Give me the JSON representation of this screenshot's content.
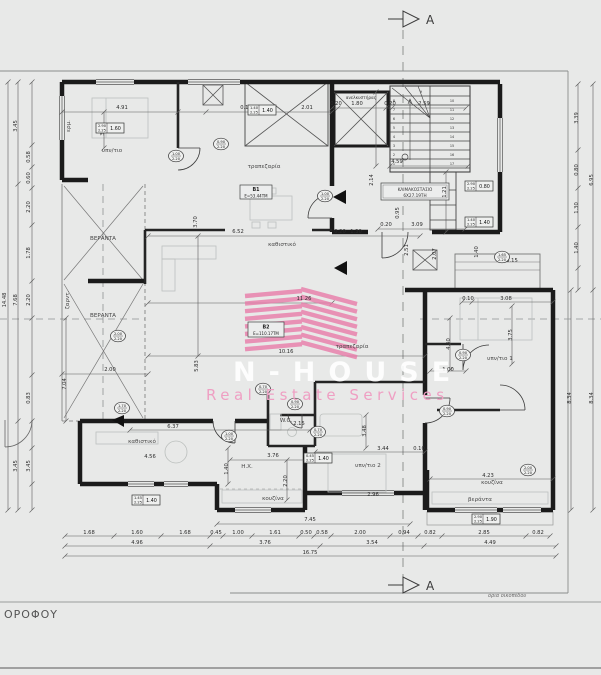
{
  "title_block": {
    "floor_label": "ΟΡΟΦΟΥ"
  },
  "section": {
    "top": "A",
    "bottom": "A"
  },
  "site": {
    "boundary_note": "όρια οικοπέδου"
  },
  "watermark": {
    "brand": "N-HOUSE",
    "tagline": "Real Estate Services",
    "stripe_color": "#e87ca9",
    "tagline_color": "#ef9fc3",
    "brand_color": "rgba(255,255,255,0.88)"
  },
  "units": [
    {
      "id": "Β1",
      "area": "Ε=53.44ΤΜ"
    },
    {
      "id": "Β2",
      "area": "Ε=110.17ΤΜ"
    }
  ],
  "stair": {
    "label_line1": "ΚΛΙΜΑΚΟΣΤΑΣΙΟ",
    "label_line2": "6Χ27.19ΤΗ",
    "treads": 17
  },
  "elevator": {
    "label": "ανελκυστήρας"
  },
  "rooms": [
    {
      "t": "υπν/τιο",
      "x": 112,
      "y": 152
    },
    {
      "t": "τραπεζαρία",
      "x": 264,
      "y": 168
    },
    {
      "t": "καθιστικό",
      "x": 282,
      "y": 246
    },
    {
      "t": "τραπεζαρία",
      "x": 352,
      "y": 348
    },
    {
      "t": "υπν/τιο 1",
      "x": 500,
      "y": 360
    },
    {
      "t": "υπν/τιο 2",
      "x": 368,
      "y": 467
    },
    {
      "t": "καθιστικό",
      "x": 142,
      "y": 443
    },
    {
      "t": "κουζίνα",
      "x": 273,
      "y": 500
    },
    {
      "t": "κουζίνα",
      "x": 492,
      "y": 484
    },
    {
      "t": "Η.Χ.",
      "x": 247,
      "y": 468
    },
    {
      "t": "W.C.",
      "x": 286,
      "y": 422
    },
    {
      "t": "ΒΕΡΑΝΤΑ",
      "x": 103,
      "y": 240
    },
    {
      "t": "ΒΕΡΑΝΤΑ",
      "x": 103,
      "y": 317
    },
    {
      "t": "βεράντα",
      "x": 480,
      "y": 501
    },
    {
      "t": "ερμ.",
      "x": 70,
      "y": 126,
      "r": 1
    },
    {
      "t": "ζαρντ.",
      "x": 69,
      "y": 300,
      "r": 1
    }
  ],
  "dims": [
    {
      "t": "4.91",
      "x": 122,
      "y": 109
    },
    {
      "t": "0.10",
      "x": 246,
      "y": 109
    },
    {
      "t": "2.01",
      "x": 307,
      "y": 109
    },
    {
      "t": "0.20",
      "x": 336,
      "y": 105
    },
    {
      "t": "1.80",
      "x": 357,
      "y": 105
    },
    {
      "t": "0.20",
      "x": 390,
      "y": 105
    },
    {
      "t": "2.59",
      "x": 424,
      "y": 105
    },
    {
      "t": "3.06",
      "x": 104,
      "y": 130,
      "r": 1
    },
    {
      "t": "4.59",
      "x": 397,
      "y": 163
    },
    {
      "t": "2.14",
      "x": 373,
      "y": 180,
      "r": 1
    },
    {
      "t": "1.21",
      "x": 446,
      "y": 192,
      "r": 1
    },
    {
      "t": "0.95",
      "x": 399,
      "y": 213,
      "r": 1
    },
    {
      "t": "6.52",
      "x": 238,
      "y": 233
    },
    {
      "t": "3.70",
      "x": 197,
      "y": 222,
      "r": 1
    },
    {
      "t": "0.20",
      "x": 340,
      "y": 233
    },
    {
      "t": "1.30",
      "x": 356,
      "y": 233
    },
    {
      "t": "0.20",
      "x": 386,
      "y": 226
    },
    {
      "t": "3.09",
      "x": 417,
      "y": 226
    },
    {
      "t": "2.51",
      "x": 408,
      "y": 250,
      "r": 1
    },
    {
      "t": "2.07",
      "x": 436,
      "y": 254,
      "r": 1
    },
    {
      "t": "3.15",
      "x": 512,
      "y": 262
    },
    {
      "t": "1.40",
      "x": 478,
      "y": 252,
      "r": 1
    },
    {
      "t": "11.26",
      "x": 304,
      "y": 300
    },
    {
      "t": "10.16",
      "x": 286,
      "y": 353
    },
    {
      "t": "5.83",
      "x": 198,
      "y": 366,
      "r": 1
    },
    {
      "t": "7.04",
      "x": 66,
      "y": 384,
      "r": 1
    },
    {
      "t": "2.00",
      "x": 110,
      "y": 371
    },
    {
      "t": "0.10",
      "x": 468,
      "y": 300
    },
    {
      "t": "3.08",
      "x": 506,
      "y": 300
    },
    {
      "t": "3.75",
      "x": 512,
      "y": 335,
      "r": 1
    },
    {
      "t": "4.40",
      "x": 450,
      "y": 344,
      "r": 1
    },
    {
      "t": "1.00",
      "x": 448,
      "y": 371
    },
    {
      "t": "6.37",
      "x": 173,
      "y": 428
    },
    {
      "t": "4.56",
      "x": 150,
      "y": 458
    },
    {
      "t": "3.76",
      "x": 273,
      "y": 457
    },
    {
      "t": "2.15",
      "x": 299,
      "y": 425
    },
    {
      "t": "1.40",
      "x": 228,
      "y": 469,
      "r": 1
    },
    {
      "t": "2.20",
      "x": 287,
      "y": 481,
      "r": 1
    },
    {
      "t": "3.44",
      "x": 383,
      "y": 450
    },
    {
      "t": "3.48",
      "x": 366,
      "y": 431,
      "r": 1
    },
    {
      "t": "0.10",
      "x": 419,
      "y": 450
    },
    {
      "t": "2.96",
      "x": 373,
      "y": 496
    },
    {
      "t": "4.23",
      "x": 488,
      "y": 477
    },
    {
      "t": "14.48",
      "x": 6,
      "y": 300,
      "r": 1
    },
    {
      "t": "3.45",
      "x": 17,
      "y": 126,
      "r": 1
    },
    {
      "t": "7.68",
      "x": 17,
      "y": 300,
      "r": 1
    },
    {
      "t": "3.45",
      "x": 17,
      "y": 466,
      "r": 1
    },
    {
      "t": "0.58",
      "x": 30,
      "y": 157,
      "r": 1
    },
    {
      "t": "0.60",
      "x": 30,
      "y": 178,
      "r": 1
    },
    {
      "t": "2.20",
      "x": 30,
      "y": 207,
      "r": 1
    },
    {
      "t": "1.78",
      "x": 30,
      "y": 253,
      "r": 1
    },
    {
      "t": "2.20",
      "x": 30,
      "y": 300,
      "r": 1
    },
    {
      "t": "0.83",
      "x": 30,
      "y": 398,
      "r": 1
    },
    {
      "t": "3.45",
      "x": 30,
      "y": 466,
      "r": 1
    },
    {
      "t": "3.39",
      "x": 578,
      "y": 118,
      "r": 1
    },
    {
      "t": "0.80",
      "x": 578,
      "y": 170,
      "r": 1
    },
    {
      "t": "1.30",
      "x": 578,
      "y": 208,
      "r": 1
    },
    {
      "t": "1.40",
      "x": 578,
      "y": 248,
      "r": 1
    },
    {
      "t": "6.95",
      "x": 593,
      "y": 180,
      "r": 1
    },
    {
      "t": "8.34",
      "x": 571,
      "y": 398,
      "r": 1
    },
    {
      "t": "8.34",
      "x": 593,
      "y": 398,
      "r": 1
    },
    {
      "t": "7.45",
      "x": 310,
      "y": 521
    },
    {
      "t": "1.68",
      "x": 89,
      "y": 534
    },
    {
      "t": "1.60",
      "x": 137,
      "y": 534
    },
    {
      "t": "1.68",
      "x": 185,
      "y": 534
    },
    {
      "t": "0.45",
      "x": 216,
      "y": 534
    },
    {
      "t": "1.00",
      "x": 238,
      "y": 534
    },
    {
      "t": "1.61",
      "x": 275,
      "y": 534
    },
    {
      "t": "0.50",
      "x": 306,
      "y": 534
    },
    {
      "t": "0.58",
      "x": 322,
      "y": 534
    },
    {
      "t": "2.00",
      "x": 360,
      "y": 534
    },
    {
      "t": "0.94",
      "x": 404,
      "y": 534
    },
    {
      "t": "0.82",
      "x": 430,
      "y": 534
    },
    {
      "t": "2.85",
      "x": 484,
      "y": 534
    },
    {
      "t": "0.82",
      "x": 538,
      "y": 534
    },
    {
      "t": "4.96",
      "x": 137,
      "y": 544
    },
    {
      "t": "3.76",
      "x": 265,
      "y": 544
    },
    {
      "t": "3.54",
      "x": 372,
      "y": 544
    },
    {
      "t": "4.49",
      "x": 490,
      "y": 544
    },
    {
      "t": "16.75",
      "x": 310,
      "y": 554
    }
  ],
  "tags_rect": [
    {
      "a": "2.90",
      "b": "2.25",
      "m": "1.60",
      "x": 110,
      "y": 128
    },
    {
      "a": "1.40",
      "b": "2.25",
      "m": "1.40",
      "x": 262,
      "y": 110
    },
    {
      "a": "2.90",
      "b": "2.25",
      "m": "0.80",
      "x": 479,
      "y": 186
    },
    {
      "a": "1.40",
      "b": "2.25",
      "m": "1.40",
      "x": 479,
      "y": 222
    },
    {
      "a": "1.45",
      "b": "2.25",
      "m": "1.40",
      "x": 146,
      "y": 500
    },
    {
      "a": "2.90",
      "b": "2.25",
      "m": "1.90",
      "x": 486,
      "y": 519
    },
    {
      "a": "0.45",
      "b": "2.25",
      "m": "1.40",
      "x": 318,
      "y": 458
    }
  ],
  "tags_oval": [
    {
      "a": "1.00",
      "b": "2.20",
      "x": 176,
      "y": 156
    },
    {
      "a": "0.90",
      "b": "2.20",
      "x": 221,
      "y": 144
    },
    {
      "a": "1.00",
      "b": "2.20",
      "x": 325,
      "y": 196
    },
    {
      "a": "2.00",
      "b": "2.20",
      "x": 118,
      "y": 336
    },
    {
      "a": "1.70",
      "b": "2.20",
      "x": 122,
      "y": 408
    },
    {
      "a": "0.90",
      "b": "2.20",
      "x": 295,
      "y": 404
    },
    {
      "a": "0.70",
      "b": "2.20",
      "x": 263,
      "y": 389
    },
    {
      "a": "0.70",
      "b": "2.20",
      "x": 318,
      "y": 432
    },
    {
      "a": "0.90",
      "b": "2.20",
      "x": 463,
      "y": 355
    },
    {
      "a": "0.90",
      "b": "2.20",
      "x": 447,
      "y": 411
    },
    {
      "a": "2.00",
      "b": "2.20",
      "x": 528,
      "y": 470
    },
    {
      "a": "1.65",
      "b": "2.20",
      "x": 502,
      "y": 257
    },
    {
      "a": "1.00",
      "b": "2.20",
      "x": 229,
      "y": 436
    }
  ]
}
